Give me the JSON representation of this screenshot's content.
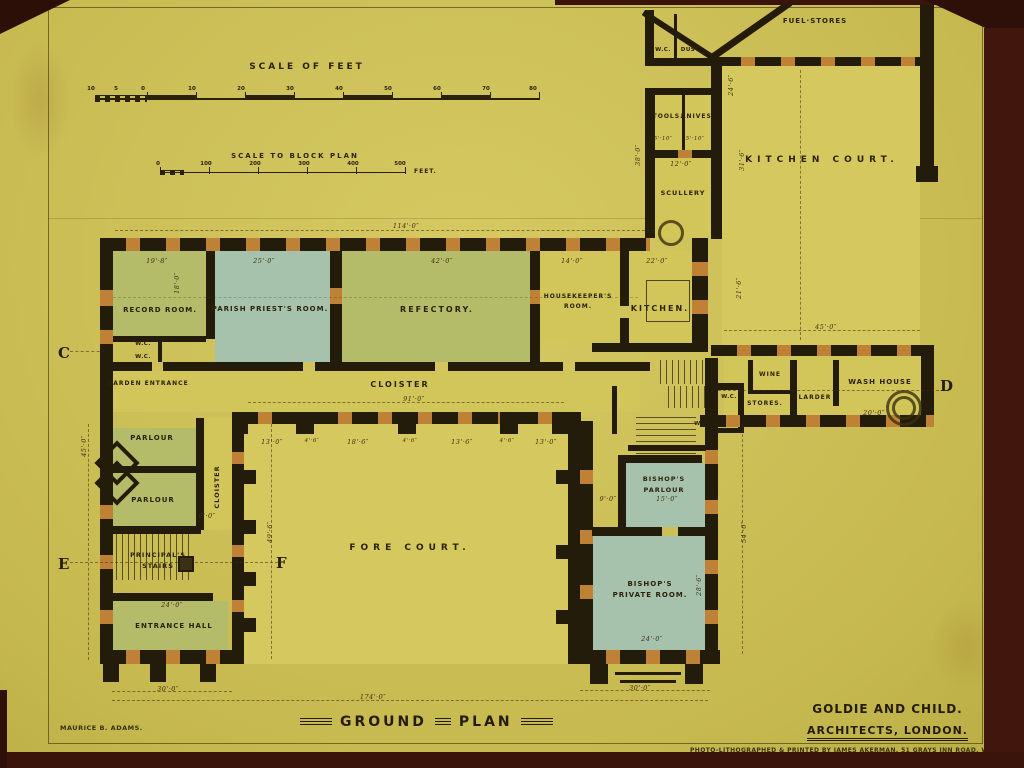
{
  "titles": {
    "ground_plan_1": "GROUND",
    "ground_plan_2": "PLAN",
    "architects_1": "GOLDIE AND CHILD.",
    "architects_2": "ARCHITECTS, LONDON.",
    "printer": "PHOTO-LITHOGRAPHED & PRINTED BY JAMES AKERMAN, 51 GRAYS INN ROAD, W.C.",
    "delineator": "MAURICE B. ADAMS."
  },
  "scales": {
    "feet_title": "SCALE OF FEET",
    "block_title": "SCALE TO BLOCK PLAN",
    "feet_unit": "FEET.",
    "feet_ticks": [
      "10",
      "5",
      "0",
      "10",
      "20",
      "30",
      "40",
      "50",
      "60",
      "70",
      "80"
    ],
    "block_ticks": [
      "0",
      "100",
      "200",
      "300",
      "400",
      "500"
    ]
  },
  "markers": {
    "c": "C",
    "d": "D",
    "e": "E",
    "f": "F"
  },
  "rooms": {
    "fuel_stores": "FUEL·STORES",
    "wc_top": "W.C.",
    "dust": "DUST.",
    "tools": "TOOLS.",
    "knives": "KNIVES.",
    "scullery": "SCULLERY",
    "kitchen_court": "KITCHEN COURT.",
    "record_room": "RECORD ROOM.",
    "parish": "PARISH PRIEST'S ROOM.",
    "refectory": "REFECTORY.",
    "hk1": "HOUSEKEEPER'S",
    "hk2": "ROOM.",
    "kitchen": "KITCHEN.",
    "garden_entrance": "GARDEN ENTRANCE",
    "cloister_h": "CLOISTER",
    "cloister_v": "CLOISTER",
    "wine": "WINE",
    "stores": "STORES.",
    "larder": "LARDER",
    "wash_house": "WASH HOUSE",
    "parlour1": "PARLOUR",
    "parlour2": "PARLOUR",
    "principals1": "PRINCIPAL'S",
    "principals2": "STAIRS",
    "entrance_hall": "ENTRANCE HALL",
    "fore_court": "FORE COURT.",
    "bp1": "BISHOP'S",
    "bp2": "PARLOUR",
    "bpr1": "BISHOP'S",
    "bpr2": "PRIVATE ROOM.",
    "wc_l1": "W.C.",
    "wc_l2": "W.C.",
    "wc_b1": "W.C.",
    "wc_b2": "W.C."
  },
  "dims": [
    "114'·0″",
    "19'·8″",
    "18'·0″",
    "25'·0″",
    "42'·0″",
    "14'·0″",
    "22'·0″",
    "38'·0″",
    "31'·6″",
    "12'·0″",
    "5'·10″",
    "5'·10″",
    "24'·6″",
    "45'·0″",
    "21'·6″",
    "91'·0″",
    "13'·0″",
    "4'·6″",
    "18'·6″",
    "4'·6″",
    "13'·6″",
    "4'·6″",
    "13'·0″",
    "9'·0″",
    "49'·6″",
    "54'·0″",
    "9'·0″",
    "15'·0″",
    "28'·6″",
    "24'·0″",
    "24'·0″",
    "30'·0″",
    "174'·0″",
    "30'·0″",
    "45'·0″",
    "20'·0″"
  ],
  "colors": {
    "paper": "#cdc058",
    "ink": "#241c0a",
    "wash_green": "#b4bc69",
    "wash_blue": "#a6c2ac",
    "window_orange": "#bf8136",
    "backing": "#41160c"
  }
}
